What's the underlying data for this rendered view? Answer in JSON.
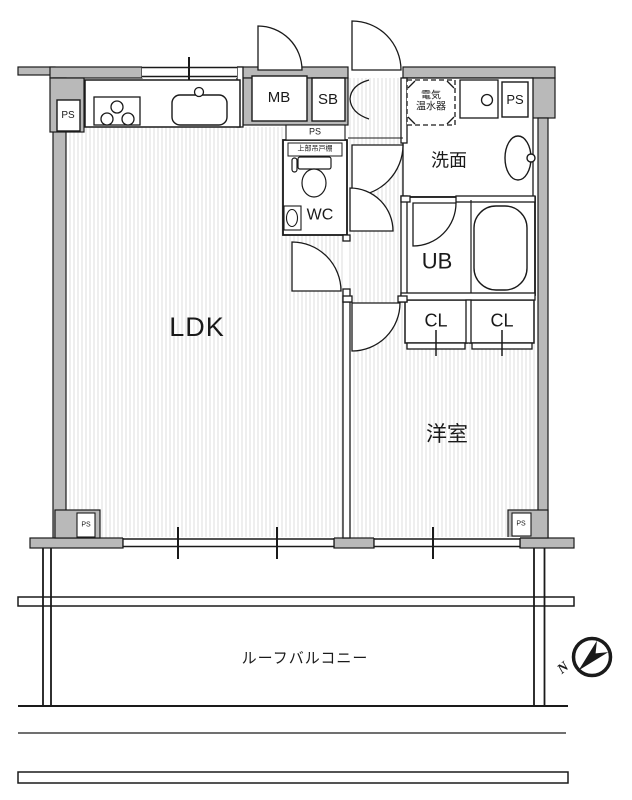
{
  "document_type": "apartment-floor-plan",
  "rooms": {
    "ldk": "LDK",
    "western_room": "洋室",
    "washroom": "洗面",
    "unit_bath": "UB",
    "toilet": "WC",
    "closet_left": "CL",
    "closet_right": "CL"
  },
  "labels": {
    "meter_box": "MB",
    "shoe_box": "SB",
    "pipe_space": "PS",
    "water_heater_line1": "電気",
    "water_heater_line2": "温水器",
    "upper_cabinet": "上部吊戸棚",
    "roof_balcony": "ルーフバルコニー",
    "compass_north": "N"
  },
  "colors": {
    "wall_fill": "#b9b9b9",
    "line": "#1a1a1a",
    "floor_hatch": "#dcdcdc",
    "floor": "#ffffff"
  }
}
